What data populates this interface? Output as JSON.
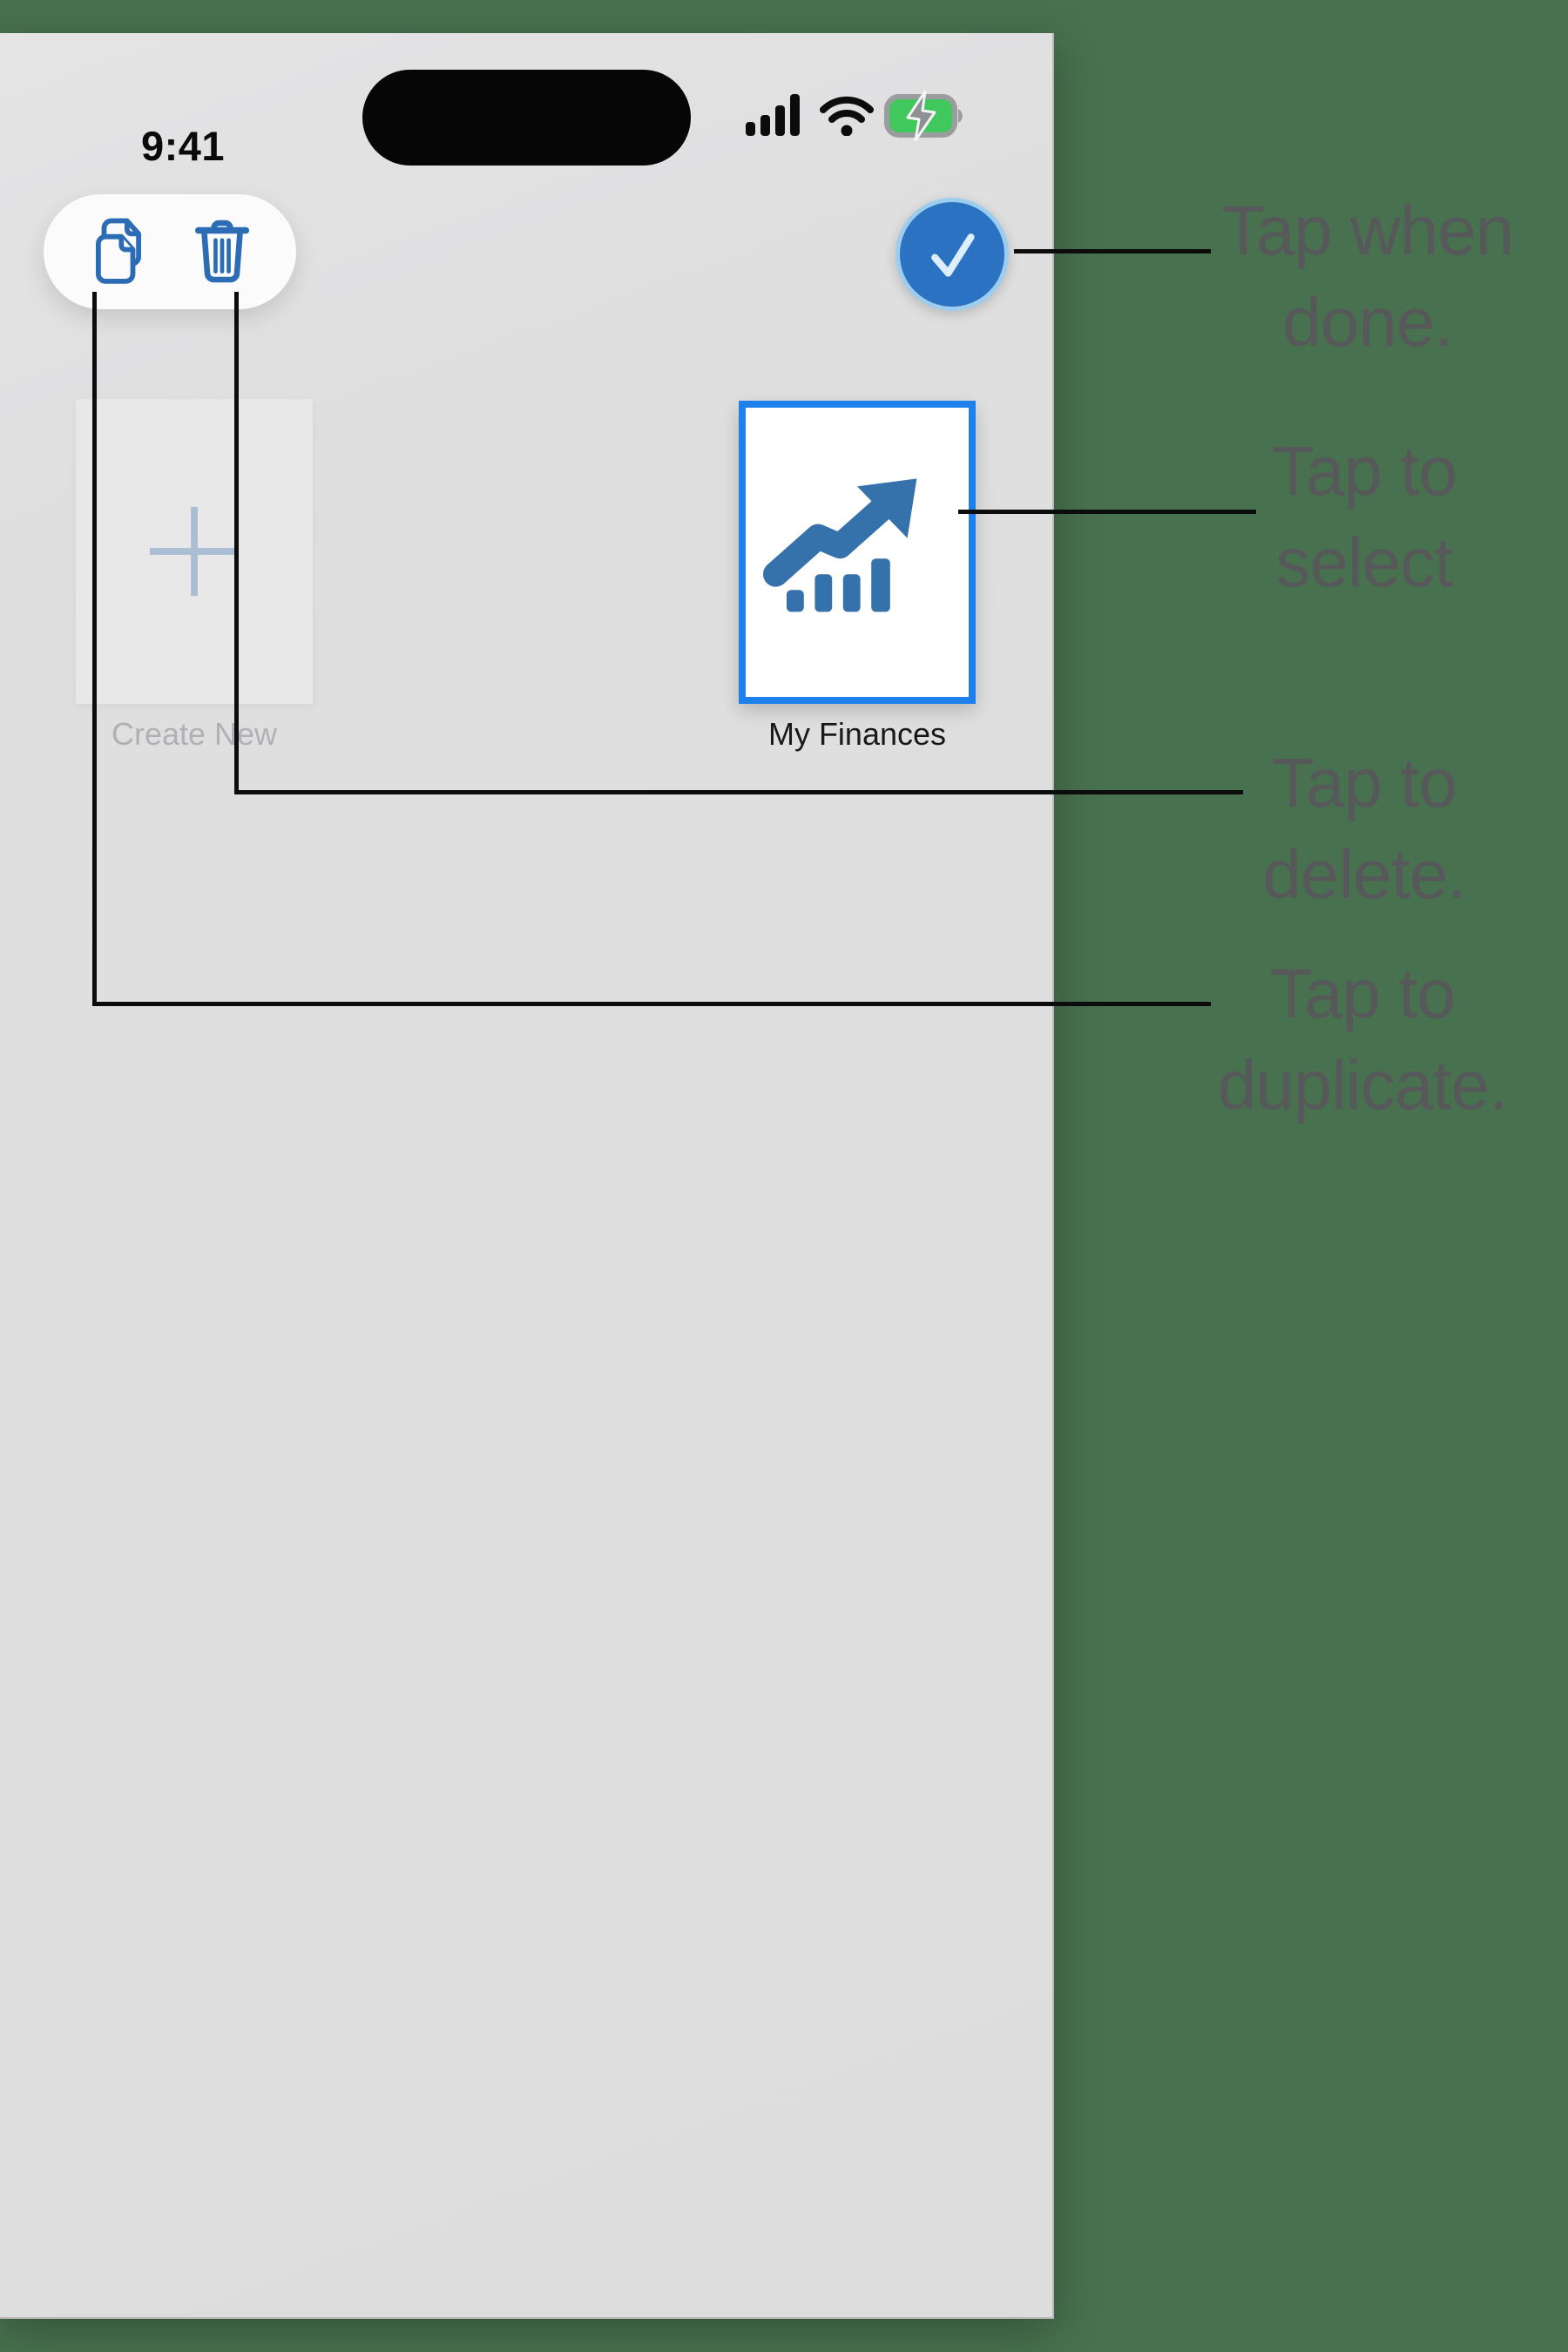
{
  "status_bar": {
    "time": "9:41",
    "icons": [
      "cellular-signal-icon",
      "wifi-icon",
      "battery-charging-icon"
    ]
  },
  "toolbar": {
    "duplicate_icon": "duplicate-pages-icon",
    "delete_icon": "trash-icon"
  },
  "done_button": {
    "icon": "checkmark-icon"
  },
  "cards": {
    "create_new": {
      "label": "Create New",
      "icon": "plus-icon"
    },
    "finances": {
      "label": "My Finances",
      "icon": "trending-chart-icon",
      "selected": true
    }
  },
  "annotations": {
    "done": {
      "line1": "Tap when",
      "line2": "done."
    },
    "select": {
      "line1": "Tap to",
      "line2": "select"
    },
    "delete": {
      "line1": "Tap to",
      "line2": "delete."
    },
    "duplicate": {
      "line1": "Tap to",
      "line2": "duplicate."
    }
  },
  "colors": {
    "background_green": "#48714f",
    "screen_gray": "#dfdfe0",
    "toolbar_icon_blue": "#2b6cb5",
    "done_circle_blue": "#2b73c2",
    "done_ring_blue": "#9ccdef",
    "selection_border_blue": "#1e80ea",
    "chart_icon_blue": "#3572ab",
    "plus_gray_blue": "#a9bdd3",
    "annotation_gray": "#56585a",
    "connector_black": "#0c0c0c",
    "battery_green": "#41c85d"
  }
}
